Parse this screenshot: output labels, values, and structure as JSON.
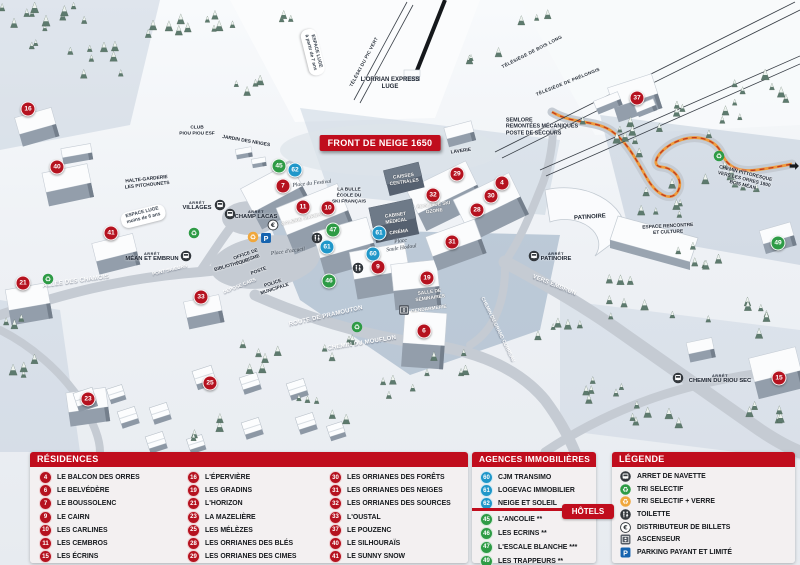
{
  "map": {
    "banner": "FRONT DE NEIGE 1650",
    "markers": [
      {
        "n": "16",
        "x": 28,
        "y": 109,
        "c": "residence"
      },
      {
        "n": "40",
        "x": 57,
        "y": 167,
        "c": "residence"
      },
      {
        "n": "41",
        "x": 111,
        "y": 233,
        "c": "residence"
      },
      {
        "n": "21",
        "x": 23,
        "y": 283,
        "c": "residence"
      },
      {
        "n": "33",
        "x": 201,
        "y": 297,
        "c": "residence"
      },
      {
        "n": "23",
        "x": 88,
        "y": 399,
        "c": "residence"
      },
      {
        "n": "25",
        "x": 210,
        "y": 383,
        "c": "residence"
      },
      {
        "n": "45",
        "x": 279,
        "y": 166,
        "c": "hotel"
      },
      {
        "n": "62",
        "x": 295,
        "y": 170,
        "c": "agence"
      },
      {
        "n": "7",
        "x": 283,
        "y": 186,
        "c": "residence"
      },
      {
        "n": "11",
        "x": 303,
        "y": 207,
        "c": "residence"
      },
      {
        "n": "10",
        "x": 328,
        "y": 208,
        "c": "residence"
      },
      {
        "n": "47",
        "x": 333,
        "y": 230,
        "c": "hotel"
      },
      {
        "n": "61",
        "x": 327,
        "y": 247,
        "c": "agence"
      },
      {
        "n": "61",
        "x": 379,
        "y": 233,
        "c": "agence"
      },
      {
        "n": "60",
        "x": 373,
        "y": 254,
        "c": "agence"
      },
      {
        "n": "9",
        "x": 378,
        "y": 267,
        "c": "residence"
      },
      {
        "n": "46",
        "x": 329,
        "y": 281,
        "c": "hotel"
      },
      {
        "n": "19",
        "x": 427,
        "y": 278,
        "c": "residence"
      },
      {
        "n": "29",
        "x": 457,
        "y": 174,
        "c": "residence"
      },
      {
        "n": "32",
        "x": 433,
        "y": 195,
        "c": "residence"
      },
      {
        "n": "30",
        "x": 491,
        "y": 196,
        "c": "residence"
      },
      {
        "n": "28",
        "x": 477,
        "y": 210,
        "c": "residence"
      },
      {
        "n": "4",
        "x": 502,
        "y": 183,
        "c": "residence"
      },
      {
        "n": "31",
        "x": 452,
        "y": 242,
        "c": "residence"
      },
      {
        "n": "6",
        "x": 424,
        "y": 331,
        "c": "residence"
      },
      {
        "n": "37",
        "x": 637,
        "y": 98,
        "c": "residence"
      },
      {
        "n": "15",
        "x": 779,
        "y": 378,
        "c": "residence"
      },
      {
        "n": "49",
        "x": 778,
        "y": 243,
        "c": "hotel"
      }
    ],
    "labels": [
      {
        "t": "TÉLÉSKI DU PIC VERT",
        "x": 364,
        "y": 62,
        "r": -62,
        "s": "lift"
      },
      {
        "t": "TÉLÉSIÈGE DE BOIS LONG",
        "x": 532,
        "y": 52,
        "r": -27,
        "s": "lift"
      },
      {
        "t": "TÉLÉSIÈGE DE PRÉLONGIS",
        "x": 568,
        "y": 82,
        "r": -22,
        "s": "lift"
      },
      {
        "t": "L'ORRIAN EXPRESS\nLUGE",
        "x": 390,
        "y": 84,
        "r": 0,
        "s": "dark"
      },
      {
        "t": "ESPACE LUGE\nà partir de 7 ans",
        "x": 313,
        "y": 52,
        "r": 76,
        "s": "pill"
      },
      {
        "t": "ESPACE LUGE\nmoins de 6 ans",
        "x": 143,
        "y": 216,
        "r": -14,
        "s": "pill"
      },
      {
        "t": "SEMLORE\nREMONTÉES MÉCANIQUES\nPOSTE DE SECOURS",
        "x": 542,
        "y": 127,
        "r": 0,
        "s": "dark-left"
      },
      {
        "t": "CLUB\nPIOU PIOU ESF",
        "x": 197,
        "y": 131,
        "r": 0,
        "s": "dark-sm"
      },
      {
        "t": "JARDIN DES NEIGES",
        "x": 246,
        "y": 142,
        "r": 10,
        "s": "dark-sm"
      },
      {
        "t": "HALTE-GARDERIE\nLES PITCHOUNETS",
        "x": 147,
        "y": 183,
        "r": -6,
        "s": "dark-sm"
      },
      {
        "t": "LA BULLE\nÉCOLE DU\nSKI FRANÇAIS",
        "x": 349,
        "y": 196,
        "r": 0,
        "s": "dark-sm"
      },
      {
        "t": "LAVERIE",
        "x": 461,
        "y": 152,
        "r": -8,
        "s": "dark-sm"
      },
      {
        "t": "CAISSES\nCENTRALES",
        "x": 404,
        "y": 180,
        "r": -8,
        "s": "bld"
      },
      {
        "t": "ÉCOLE DE SKI\nOZONE",
        "x": 434,
        "y": 209,
        "r": -8,
        "s": "bld"
      },
      {
        "t": "CABINET\nMÉDICAL",
        "x": 396,
        "y": 219,
        "r": -8,
        "s": "bld"
      },
      {
        "t": "CINÉMA",
        "x": 399,
        "y": 233,
        "r": -8,
        "s": "bld"
      },
      {
        "t": "GALERIE MARCHANDE",
        "x": 308,
        "y": 219,
        "r": -14,
        "s": "bld"
      },
      {
        "t": "SALLE DE\nSÉMINAIRES",
        "x": 430,
        "y": 296,
        "r": -8,
        "s": "bld"
      },
      {
        "t": "GENDARMERIE",
        "x": 429,
        "y": 310,
        "r": -8,
        "s": "bld"
      },
      {
        "t": "PATINOIRE",
        "x": 590,
        "y": 218,
        "r": -4,
        "s": "dark"
      },
      {
        "t": "ESPACE RENCONTRE\nET CULTURE",
        "x": 668,
        "y": 230,
        "r": -3,
        "s": "dark-sm"
      },
      {
        "t": "Place du Festival",
        "x": 312,
        "y": 184,
        "r": -6,
        "s": "script"
      },
      {
        "t": "Place d'accueil",
        "x": 288,
        "y": 252,
        "r": -8,
        "s": "script"
      },
      {
        "t": "Place\nSaule Hodoul",
        "x": 401,
        "y": 245,
        "r": -8,
        "s": "script"
      },
      {
        "t": "BIBLIOTHÈQUE",
        "x": 232,
        "y": 266,
        "r": -16,
        "s": "dark-sm"
      },
      {
        "t": "OFFICE DE\nTOURISME",
        "x": 247,
        "y": 258,
        "r": -20,
        "s": "dark-sm"
      },
      {
        "t": "POSTE",
        "x": 259,
        "y": 272,
        "r": -20,
        "s": "dark-sm"
      },
      {
        "t": "DÉPOSE CARS",
        "x": 240,
        "y": 287,
        "r": -22,
        "s": "road-sm"
      },
      {
        "t": "POLICE\nMUNICIPALE",
        "x": 274,
        "y": 287,
        "r": -18,
        "s": "dark-sm"
      },
      {
        "t": "ALLÉE DES CHAMOIS",
        "x": 76,
        "y": 282,
        "r": -8,
        "s": "road"
      },
      {
        "t": "PONT SKIEURS",
        "x": 170,
        "y": 271,
        "r": -14,
        "s": "road-sm"
      },
      {
        "t": "ROUTE DE PRAMOUTON",
        "x": 326,
        "y": 317,
        "r": -13,
        "s": "road"
      },
      {
        "t": "CHEMIN DU MOUFLON",
        "x": 362,
        "y": 344,
        "r": -9,
        "s": "road"
      },
      {
        "t": "CHEMIN DU GRAND CORREAU",
        "x": 497,
        "y": 330,
        "r": 64,
        "s": "road-sm"
      },
      {
        "t": "VERS EMBRUN",
        "x": 554,
        "y": 286,
        "r": 22,
        "s": "road"
      },
      {
        "t": "CHEMIN PITTORESQUE\nVERS LES ORRES 1800\nBOIS MÉAN",
        "x": 744,
        "y": 180,
        "r": 14,
        "s": "dark-sm"
      }
    ],
    "stops": [
      {
        "small": "ARRÊT",
        "t": "VILLAGES",
        "x": 197,
        "y": 206
      },
      {
        "small": "ARRÊT",
        "t": "CHAMP LACAS",
        "x": 256,
        "y": 215
      },
      {
        "small": "ARRÊT",
        "t": "MÉAN ET EMBRUN",
        "x": 152,
        "y": 257
      },
      {
        "small": "ARRÊT",
        "t": "PATINOIRE",
        "x": 556,
        "y": 257
      },
      {
        "small": "ARRÊT",
        "t": "CHEMIN DU RIOU SEC",
        "x": 720,
        "y": 379
      }
    ],
    "icons": [
      {
        "name": "bus",
        "x": 220,
        "y": 205
      },
      {
        "name": "bus",
        "x": 230,
        "y": 214
      },
      {
        "name": "bus",
        "x": 186,
        "y": 256
      },
      {
        "name": "bus",
        "x": 534,
        "y": 256
      },
      {
        "name": "bus",
        "x": 678,
        "y": 378
      },
      {
        "name": "recycle-green",
        "x": 48,
        "y": 279
      },
      {
        "name": "recycle-green",
        "x": 194,
        "y": 233
      },
      {
        "name": "recycle-green",
        "x": 357,
        "y": 327
      },
      {
        "name": "recycle-green",
        "x": 719,
        "y": 156
      },
      {
        "name": "recycle-yellow",
        "x": 253,
        "y": 237
      },
      {
        "name": "parking",
        "x": 266,
        "y": 238
      },
      {
        "name": "euro",
        "x": 273,
        "y": 225
      },
      {
        "name": "wc",
        "x": 317,
        "y": 238
      },
      {
        "name": "wc",
        "x": 358,
        "y": 268
      },
      {
        "name": "lift",
        "x": 404,
        "y": 310
      },
      {
        "name": "arrow-right",
        "x": 794,
        "y": 166
      }
    ]
  },
  "panels": {
    "residences": {
      "title": "RÉSIDENCES",
      "columns": [
        [
          {
            "n": "4",
            "name": "LE BALCON DES ORRES"
          },
          {
            "n": "6",
            "name": "LE BELVÉDÈRE"
          },
          {
            "n": "7",
            "name": "LE BOUSSOLENC"
          },
          {
            "n": "9",
            "name": "LE CAIRN"
          },
          {
            "n": "10",
            "name": "LES CARLINES"
          },
          {
            "n": "11",
            "name": "LES CEMBROS"
          },
          {
            "n": "15",
            "name": "LES ÉCRINS"
          }
        ],
        [
          {
            "n": "16",
            "name": "L'ÉPERVIÈRE"
          },
          {
            "n": "19",
            "name": "LES GRADINS"
          },
          {
            "n": "21",
            "name": "L'HORIZON"
          },
          {
            "n": "23",
            "name": "LA MAZELIÈRE"
          },
          {
            "n": "25",
            "name": "LES MÉLÈZES"
          },
          {
            "n": "28",
            "name": "LES ORRIANES DES BLÉS"
          },
          {
            "n": "29",
            "name": "LES ORRIANES DES CIMES"
          }
        ],
        [
          {
            "n": "30",
            "name": "LES ORRIANES DES FORÊTS"
          },
          {
            "n": "31",
            "name": "LES ORRIANES DES NEIGES"
          },
          {
            "n": "32",
            "name": "LES ORRIANES DES SOURCES"
          },
          {
            "n": "33",
            "name": "L'OUSTAL"
          },
          {
            "n": "37",
            "name": "LE POUZENC"
          },
          {
            "n": "40",
            "name": "LE SILHOURAÏS"
          },
          {
            "n": "41",
            "name": "LE SUNNY SNOW"
          }
        ]
      ]
    },
    "agences": {
      "title": "AGENCES IMMOBILIÈRES",
      "items": [
        {
          "n": "60",
          "name": "CJM TRANSIMO"
        },
        {
          "n": "61",
          "name": "LOGEVAC IMMOBILIER"
        },
        {
          "n": "62",
          "name": "NEIGE ET SOLEIL"
        }
      ]
    },
    "hotels": {
      "title": "HÔTELS",
      "items": [
        {
          "n": "45",
          "name": "L'ANCOLIE **"
        },
        {
          "n": "46",
          "name": "LES ECRINS **"
        },
        {
          "n": "47",
          "name": "L'ESCALE BLANCHE ***"
        },
        {
          "n": "49",
          "name": "LES TRAPPEURS **"
        }
      ]
    },
    "legende": {
      "title": "LÉGENDE",
      "items": [
        {
          "icon": "bus",
          "label": "ARRET DE NAVETTE"
        },
        {
          "icon": "recycle-green",
          "label": "TRI SELECTIF"
        },
        {
          "icon": "recycle-yellow",
          "label": "TRI SELECTIF + VERRE"
        },
        {
          "icon": "wc",
          "label": "TOILETTE"
        },
        {
          "icon": "euro",
          "label": "DISTRIBUTEUR DE BILLETS"
        },
        {
          "icon": "lift",
          "label": "ASCENSEUR"
        },
        {
          "icon": "parking",
          "label": "PARKING PAYANT ET LIMITÉ"
        }
      ]
    }
  },
  "colors": {
    "residence": "#b5121f",
    "hotel": "#2e9b45",
    "agence": "#2097c9",
    "header": "#c00d1d",
    "panel_bg": "#f3f0f1"
  }
}
